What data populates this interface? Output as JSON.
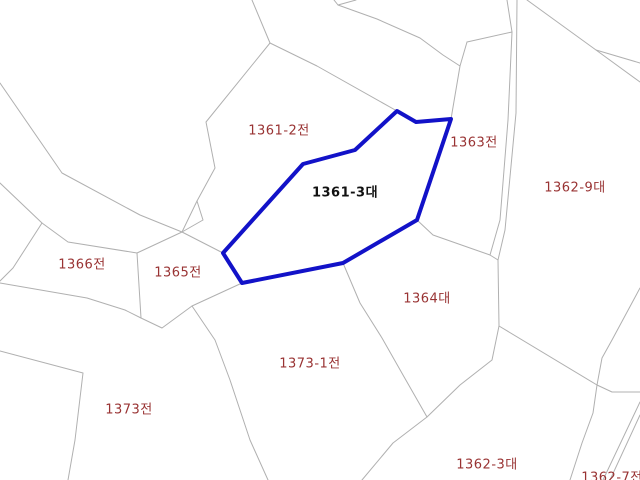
{
  "map": {
    "background_color": "#ffffff",
    "boundary_line_color": "#b0b0b0",
    "parcel_label_color": "#993333",
    "selected_parcel": {
      "label": "1361-3대",
      "label_color": "#111111",
      "outline_color": "#1212c8",
      "outline_width": 4,
      "label_x": 345,
      "label_y": 191,
      "vertices": [
        [
          397,
          111
        ],
        [
          416,
          122
        ],
        [
          451,
          119
        ],
        [
          417,
          220
        ],
        [
          343,
          263
        ],
        [
          242,
          283
        ],
        [
          223,
          253
        ],
        [
          303,
          164
        ],
        [
          355,
          150
        ]
      ]
    },
    "parcel_labels": [
      {
        "text": "1361-2전",
        "x": 279,
        "y": 129
      },
      {
        "text": "1363전",
        "x": 474,
        "y": 141
      },
      {
        "text": "1362-9대",
        "x": 575,
        "y": 186
      },
      {
        "text": "1366전",
        "x": 82,
        "y": 263
      },
      {
        "text": "1365전",
        "x": 178,
        "y": 271
      },
      {
        "text": "1364대",
        "x": 427,
        "y": 297
      },
      {
        "text": "1373-1전",
        "x": 310,
        "y": 362
      },
      {
        "text": "1373전",
        "x": 129,
        "y": 408
      },
      {
        "text": "1362-3대",
        "x": 487,
        "y": 463
      },
      {
        "text": "1362-7전",
        "x": 612,
        "y": 476
      }
    ],
    "boundaries": [
      [
        [
          252,
          0
        ],
        [
          270,
          43
        ]
      ],
      [
        [
          270,
          43
        ],
        [
          206,
          122
        ],
        [
          215,
          168
        ],
        [
          197,
          201
        ],
        [
          182,
          232
        ]
      ],
      [
        [
          270,
          43
        ],
        [
          317,
          66
        ],
        [
          397,
          111
        ]
      ],
      [
        [
          0,
          83
        ],
        [
          62,
          173
        ],
        [
          140,
          215
        ],
        [
          182,
          232
        ]
      ],
      [
        [
          182,
          232
        ],
        [
          137,
          253
        ]
      ],
      [
        [
          182,
          232
        ],
        [
          203,
          220
        ],
        [
          197,
          201
        ]
      ],
      [
        [
          182,
          232
        ],
        [
          223,
          253
        ]
      ],
      [
        [
          0,
          183
        ],
        [
          42,
          223
        ]
      ],
      [
        [
          42,
          223
        ],
        [
          13,
          268
        ],
        [
          0,
          281
        ]
      ],
      [
        [
          42,
          223
        ],
        [
          68,
          242
        ],
        [
          137,
          253
        ]
      ],
      [
        [
          137,
          253
        ],
        [
          141,
          318
        ]
      ],
      [
        [
          0,
          283
        ],
        [
          87,
          298
        ],
        [
          125,
          310
        ],
        [
          141,
          318
        ]
      ],
      [
        [
          141,
          318
        ],
        [
          162,
          328
        ],
        [
          192,
          306
        ]
      ],
      [
        [
          192,
          306
        ],
        [
          242,
          283
        ]
      ],
      [
        [
          192,
          306
        ],
        [
          215,
          340
        ],
        [
          230,
          380
        ],
        [
          250,
          440
        ],
        [
          268,
          480
        ]
      ],
      [
        [
          0,
          351
        ],
        [
          83,
          373
        ],
        [
          75,
          440
        ],
        [
          68,
          480
        ]
      ],
      [
        [
          334,
          0
        ],
        [
          338,
          5
        ],
        [
          377,
          19
        ],
        [
          420,
          38
        ],
        [
          443,
          55
        ],
        [
          460,
          66
        ]
      ],
      [
        [
          338,
          5
        ],
        [
          356,
          0
        ]
      ],
      [
        [
          451,
          119
        ],
        [
          460,
          66
        ],
        [
          467,
          42
        ]
      ],
      [
        [
          467,
          42
        ],
        [
          512,
          32
        ]
      ],
      [
        [
          507,
          0
        ],
        [
          512,
          32
        ],
        [
          508,
          120
        ],
        [
          500,
          220
        ],
        [
          490,
          255
        ]
      ],
      [
        [
          517,
          0
        ],
        [
          516,
          113
        ],
        [
          505,
          230
        ],
        [
          498,
          260
        ]
      ],
      [
        [
          417,
          220
        ],
        [
          433,
          235
        ],
        [
          470,
          248
        ],
        [
          490,
          255
        ],
        [
          498,
          260
        ]
      ],
      [
        [
          498,
          260
        ],
        [
          499,
          326
        ]
      ],
      [
        [
          527,
          0
        ],
        [
          596,
          50
        ]
      ],
      [
        [
          596,
          50
        ],
        [
          640,
          63
        ]
      ],
      [
        [
          596,
          50
        ],
        [
          640,
          82
        ]
      ],
      [
        [
          640,
          288
        ],
        [
          612,
          340
        ],
        [
          602,
          358
        ],
        [
          597,
          385
        ]
      ],
      [
        [
          499,
          326
        ],
        [
          597,
          385
        ]
      ],
      [
        [
          499,
          326
        ],
        [
          492,
          360
        ],
        [
          460,
          385
        ],
        [
          427,
          417
        ]
      ],
      [
        [
          343,
          263
        ],
        [
          360,
          303
        ],
        [
          382,
          338
        ],
        [
          403,
          375
        ],
        [
          427,
          417
        ]
      ],
      [
        [
          427,
          417
        ],
        [
          393,
          443
        ],
        [
          362,
          480
        ]
      ],
      [
        [
          597,
          385
        ],
        [
          612,
          392
        ],
        [
          640,
          392
        ]
      ],
      [
        [
          597,
          385
        ],
        [
          593,
          413
        ],
        [
          582,
          443
        ],
        [
          570,
          480
        ]
      ],
      [
        [
          640,
          402
        ],
        [
          603,
          480
        ]
      ],
      [
        [
          640,
          415
        ],
        [
          610,
          480
        ]
      ]
    ]
  }
}
